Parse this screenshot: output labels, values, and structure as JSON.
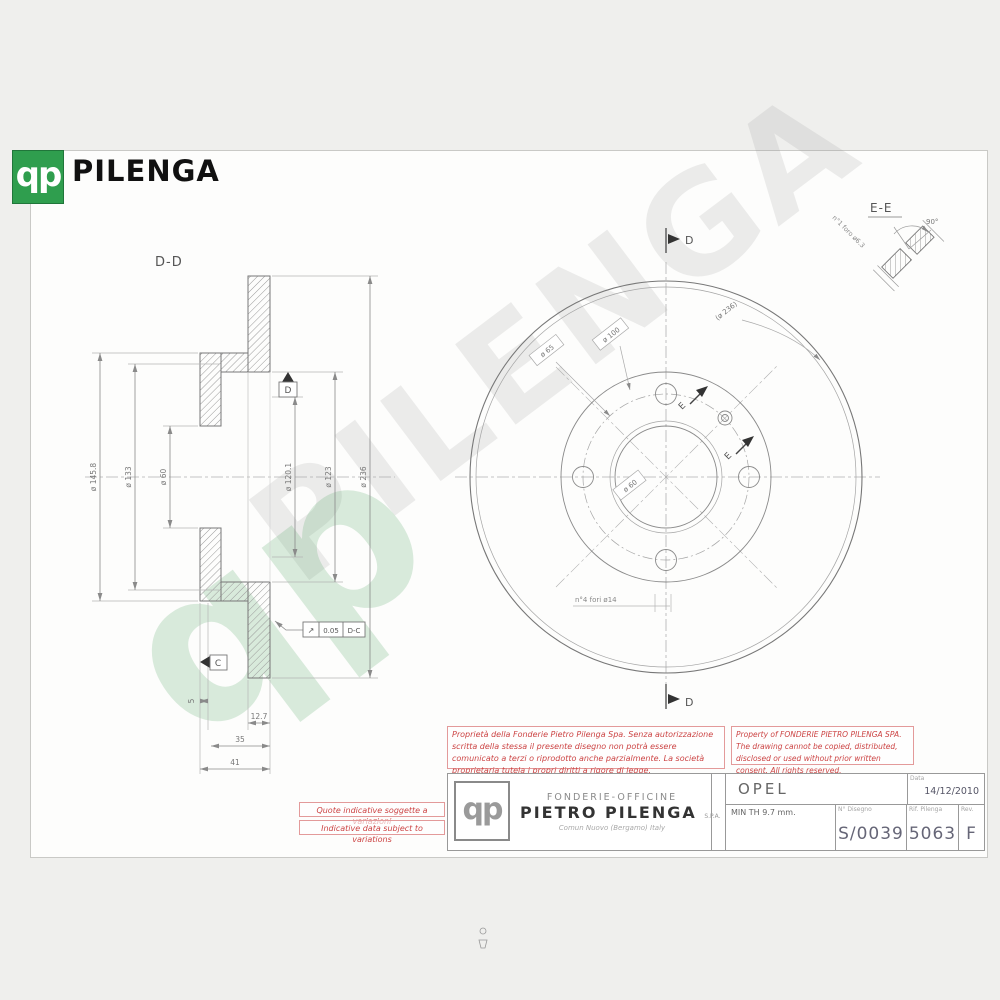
{
  "brand": {
    "monogram": "qp",
    "name": "PILENGA"
  },
  "watermark": {
    "text": "PILENGA",
    "monogram": "qp"
  },
  "views": {
    "section_dd": {
      "label": "D-D",
      "dims_left": [
        "ø 145.8",
        "ø 133",
        "ø 60"
      ],
      "dims_right": [
        "ø 120.1",
        "ø 123",
        "ø 236"
      ],
      "dim_thickness": "12.7",
      "dim_hat": "35",
      "dim_height": "41",
      "dim_small": "5",
      "datum_d": "D",
      "datum_c": "C",
      "tolerance": {
        "symbol": "↗",
        "value": "0.05",
        "datum": "D-C"
      }
    },
    "front": {
      "marker_top": "D",
      "marker_bottom": "D",
      "marker_e1": "E",
      "marker_e2": "E",
      "label_pcd": "ø 100",
      "label_hub": "ø 65",
      "label_outer_ref": "(ø 236)",
      "label_bore": "ø 60",
      "note_holes": "n°4 fori ø14"
    },
    "detail_ee": {
      "label": "E-E",
      "angle": "90°",
      "note": "n°1 foro ø6.3"
    }
  },
  "notices": {
    "italian": "Proprietà della Fonderie Pietro Pilenga Spa. Senza autorizzazione scritta della stessa il presente disegno non potrà essere comunicato a terzi o riprodotto anche parzialmente. La società proprietaria tutela i propri diritti a rigore di legge.",
    "english": "Property of FONDERIE PIETRO PILENGA SPA. The drawing cannot be copied, distributed, disclosed or used without prior written consent. All rights reserved.",
    "variation_it": "Quote indicative soggette a variazioni",
    "variation_en": "Indicative data subject to variations"
  },
  "title_block": {
    "company_line1": "FONDERIE-OFFICINE",
    "company_name": "PIETRO PILENGA",
    "company_suffix": "S.P.A.",
    "company_city": "Comun Nuovo (Bergamo) Italy",
    "logo_monogram": "qp",
    "customer": "OPEL",
    "min_thickness": "MIN TH 9.7 mm.",
    "date_label": "Data",
    "date": "14/12/2010",
    "drawing_no_label": "N° Disegno",
    "drawing_no": "S/0039",
    "ref_label": "Rif. Pilenga",
    "ref": "5063",
    "rev_label": "Rev.",
    "rev": "F"
  }
}
